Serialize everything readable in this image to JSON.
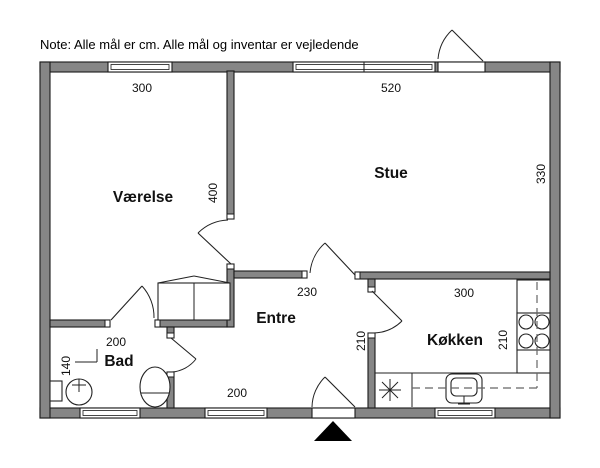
{
  "note": "Note: Alle mål er cm. Alle mål og inventar er vejledende",
  "colors": {
    "background": "#ffffff",
    "wall_fill": "#868686",
    "outline": "#1a1a1a",
    "fixture_line": "#222222",
    "dash_line": "#666666",
    "arrow_fill": "#000000"
  },
  "plan": {
    "canvas": {
      "width": 600,
      "height": 468
    },
    "room_labels": [
      {
        "id": "vaerelse",
        "label": "Værelse",
        "x": 143,
        "y": 202
      },
      {
        "id": "stue",
        "label": "Stue",
        "x": 391,
        "y": 178
      },
      {
        "id": "entre",
        "label": "Entre",
        "x": 276,
        "y": 323
      },
      {
        "id": "bad",
        "label": "Bad",
        "x": 119,
        "y": 366
      },
      {
        "id": "koekken",
        "label": "Køkken",
        "x": 455,
        "y": 345
      }
    ],
    "dimension_labels": [
      {
        "label": "300",
        "x": 142,
        "y": 92,
        "rotated": false
      },
      {
        "label": "520",
        "x": 391,
        "y": 92,
        "rotated": false
      },
      {
        "label": "400",
        "x": 217,
        "y": 193,
        "rotated": true
      },
      {
        "label": "330",
        "x": 545,
        "y": 174,
        "rotated": true
      },
      {
        "label": "230",
        "x": 307,
        "y": 296,
        "rotated": false
      },
      {
        "label": "300",
        "x": 464,
        "y": 297,
        "rotated": false
      },
      {
        "label": "210",
        "x": 365,
        "y": 341,
        "rotated": true
      },
      {
        "label": "210",
        "x": 507,
        "y": 340,
        "rotated": true
      },
      {
        "label": "200",
        "x": 116,
        "y": 346,
        "rotated": false
      },
      {
        "label": "140",
        "x": 70,
        "y": 366,
        "rotated": true
      },
      {
        "label": "200",
        "x": 237,
        "y": 397,
        "rotated": false
      }
    ],
    "walls": [
      {
        "name": "outer-wall-top",
        "x": 40,
        "y": 62,
        "w": 520,
        "h": 10
      },
      {
        "name": "outer-wall-bottom",
        "x": 40,
        "y": 408,
        "w": 520,
        "h": 10
      },
      {
        "name": "outer-wall-left",
        "x": 40,
        "y": 62,
        "w": 10,
        "h": 356
      },
      {
        "name": "outer-wall-right",
        "x": 550,
        "y": 62,
        "w": 10,
        "h": 356
      },
      {
        "name": "wall-vaerelse-stue",
        "x": 227,
        "y": 71,
        "w": 7,
        "h": 148
      },
      {
        "name": "wall-vaerelse-lower",
        "x": 227,
        "y": 264,
        "w": 7,
        "h": 63
      },
      {
        "name": "wall-entre-top-left",
        "x": 234,
        "y": 271,
        "w": 73,
        "h": 7
      },
      {
        "name": "wall-stue-south",
        "x": 355,
        "y": 272,
        "w": 195,
        "h": 7
      },
      {
        "name": "wall-koekken-stub",
        "x": 368,
        "y": 279,
        "w": 7,
        "h": 13
      },
      {
        "name": "wall-koekken-lower",
        "x": 368,
        "y": 333,
        "w": 7,
        "h": 75
      },
      {
        "name": "wall-bad-north-left",
        "x": 50,
        "y": 320,
        "w": 60,
        "h": 7
      },
      {
        "name": "wall-bad-north-right",
        "x": 155,
        "y": 320,
        "w": 72,
        "h": 7
      },
      {
        "name": "wall-bad-east-stub",
        "x": 167,
        "y": 327,
        "w": 7,
        "h": 11
      },
      {
        "name": "wall-bad-east-lower",
        "x": 167,
        "y": 372,
        "w": 7,
        "h": 36
      }
    ],
    "jambs": [
      {
        "x": 227,
        "y": 214,
        "w": 7,
        "h": 5
      },
      {
        "x": 227,
        "y": 264,
        "w": 7,
        "h": 5
      },
      {
        "x": 302,
        "y": 271,
        "w": 5,
        "h": 7
      },
      {
        "x": 355,
        "y": 272,
        "w": 5,
        "h": 7
      },
      {
        "x": 368,
        "y": 287,
        "w": 7,
        "h": 5
      },
      {
        "x": 368,
        "y": 333,
        "w": 7,
        "h": 5
      },
      {
        "x": 105,
        "y": 320,
        "w": 5,
        "h": 7
      },
      {
        "x": 155,
        "y": 320,
        "w": 5,
        "h": 7
      },
      {
        "x": 167,
        "y": 333,
        "w": 7,
        "h": 5
      },
      {
        "x": 167,
        "y": 372,
        "w": 7,
        "h": 5
      }
    ],
    "windows": [
      {
        "name": "window-vaerelse",
        "x": 108,
        "y": 62,
        "w": 64,
        "h": 10,
        "panes": 1
      },
      {
        "name": "window-stue",
        "x": 293,
        "y": 62,
        "w": 142,
        "h": 10,
        "panes": 2
      },
      {
        "name": "window-bad",
        "x": 80,
        "y": 408,
        "w": 60,
        "h": 10,
        "panes": 1
      },
      {
        "name": "window-entre",
        "x": 205,
        "y": 408,
        "w": 62,
        "h": 10,
        "panes": 1
      },
      {
        "name": "window-koekken",
        "x": 435,
        "y": 408,
        "w": 60,
        "h": 10,
        "panes": 1
      }
    ],
    "door_thresholds": [
      {
        "name": "threshold-main-entrance",
        "x": 438,
        "y": 62,
        "w": 47,
        "h": 10
      },
      {
        "name": "threshold-entre-south",
        "x": 312,
        "y": 408,
        "w": 43,
        "h": 10
      }
    ],
    "doors": [
      {
        "name": "door-main-entrance",
        "leaf": [
          483,
          61,
          452,
          30
        ],
        "arc": "M 438 59 A 45 45 0 0 1 452 30"
      },
      {
        "name": "door-stue",
        "leaf": [
          355,
          275,
          325,
          243
        ],
        "arc": "M 310 273 A 45 45 0 0 1 325 243"
      },
      {
        "name": "door-vaerelse",
        "leaf": [
          231,
          264,
          198,
          233
        ],
        "arc": "M 228 220 A 45 45 0 0 0 198 233"
      },
      {
        "name": "door-koekken",
        "leaf": [
          372,
          291,
          402,
          321
        ],
        "arc": "M 402 321 A 42 42 0 0 1 374 333"
      },
      {
        "name": "door-bad-vaerelse",
        "leaf": [
          111,
          320,
          142,
          286
        ],
        "arc": "M 142 286 A 46 46 0 0 1 154 318"
      },
      {
        "name": "door-bad-entre",
        "leaf": [
          171,
          338,
          196,
          359
        ],
        "arc": "M 196 359 A 34 34 0 0 1 172 372"
      },
      {
        "name": "door-entre-south",
        "leaf": [
          355,
          407,
          325,
          377
        ],
        "arc": "M 312 407 A 43 43 0 0 1 325 377"
      }
    ],
    "fixtures": {
      "rects": [
        {
          "name": "wardrobe",
          "x": 158,
          "y": 283,
          "w": 72,
          "h": 37,
          "rx": 0
        },
        {
          "name": "kitchen-counter-right",
          "x": 517,
          "y": 280,
          "w": 33,
          "h": 93,
          "rx": 0
        },
        {
          "name": "stove",
          "x": 517,
          "y": 313,
          "w": 33,
          "h": 37,
          "rx": 0
        },
        {
          "name": "bad-sink-pedestal",
          "x": 50,
          "y": 381,
          "w": 12,
          "h": 20,
          "rx": 0
        },
        {
          "name": "kitchen-sink-outer",
          "x": 446,
          "y": 374,
          "w": 36,
          "h": 29,
          "rx": 6
        },
        {
          "name": "kitchen-sink-inner",
          "x": 451,
          "y": 378,
          "w": 26,
          "h": 18,
          "rx": 5
        }
      ],
      "circles": [
        {
          "name": "stove-burner",
          "cx": 526,
          "cy": 322,
          "r": 7
        },
        {
          "name": "stove-burner",
          "cx": 542,
          "cy": 322,
          "r": 7
        },
        {
          "name": "stove-burner",
          "cx": 526,
          "cy": 341,
          "r": 7
        },
        {
          "name": "stove-burner",
          "cx": 542,
          "cy": 341,
          "r": 7
        },
        {
          "name": "bad-sink-basin",
          "cx": 79,
          "cy": 392,
          "r": 13
        }
      ],
      "ellipses": [
        {
          "name": "toilet",
          "cx": 155,
          "cy": 387,
          "rx": 15,
          "ry": 20
        }
      ],
      "lines": [
        {
          "name": "wardrobe-roof-left",
          "x1": 158,
          "y1": 283,
          "x2": 194,
          "y2": 276
        },
        {
          "name": "wardrobe-roof-right",
          "x1": 194,
          "y1": 276,
          "x2": 230,
          "y2": 283
        },
        {
          "name": "wardrobe-divider",
          "x1": 194,
          "y1": 283,
          "x2": 194,
          "y2": 320
        },
        {
          "name": "counter-edge-south",
          "x1": 375,
          "y1": 373,
          "x2": 517,
          "y2": 373
        },
        {
          "name": "appliance-box-right",
          "x1": 412,
          "y1": 373,
          "x2": 412,
          "y2": 407
        },
        {
          "name": "dim-leader-vertical",
          "x1": 97,
          "y1": 349,
          "x2": 97,
          "y2": 362
        },
        {
          "name": "dim-leader-horizontal",
          "x1": 75,
          "y1": 362,
          "x2": 97,
          "y2": 362
        },
        {
          "name": "bad-sink-tap-vertical",
          "x1": 79,
          "y1": 379,
          "x2": 79,
          "y2": 392
        },
        {
          "name": "bad-sink-tap-cross",
          "x1": 72,
          "y1": 385,
          "x2": 86,
          "y2": 385
        },
        {
          "name": "toilet-seat-line",
          "x1": 141,
          "y1": 393,
          "x2": 169,
          "y2": 393
        },
        {
          "name": "kitchen-tap-vertical",
          "x1": 464,
          "y1": 396,
          "x2": 464,
          "y2": 404
        },
        {
          "name": "kitchen-tap-base",
          "x1": 458,
          "y1": 404,
          "x2": 470,
          "y2": 404
        },
        {
          "name": "appliance-asterisk-h",
          "x1": 379,
          "y1": 390,
          "x2": 401,
          "y2": 390
        },
        {
          "name": "appliance-asterisk-v",
          "x1": 390,
          "y1": 379,
          "x2": 390,
          "y2": 401
        },
        {
          "name": "appliance-asterisk-d1",
          "x1": 382,
          "y1": 382,
          "x2": 398,
          "y2": 398
        },
        {
          "name": "appliance-asterisk-d2",
          "x1": 382,
          "y1": 398,
          "x2": 398,
          "y2": 382
        }
      ],
      "dashed_lines": [
        {
          "name": "counter-dash-vertical",
          "x1": 537,
          "y1": 282,
          "x2": 537,
          "y2": 388
        },
        {
          "name": "counter-dash-horizontal",
          "x1": 412,
          "y1": 388,
          "x2": 537,
          "y2": 388
        }
      ],
      "north_arrow": {
        "points": "333,421 352,441 314,441"
      }
    }
  }
}
